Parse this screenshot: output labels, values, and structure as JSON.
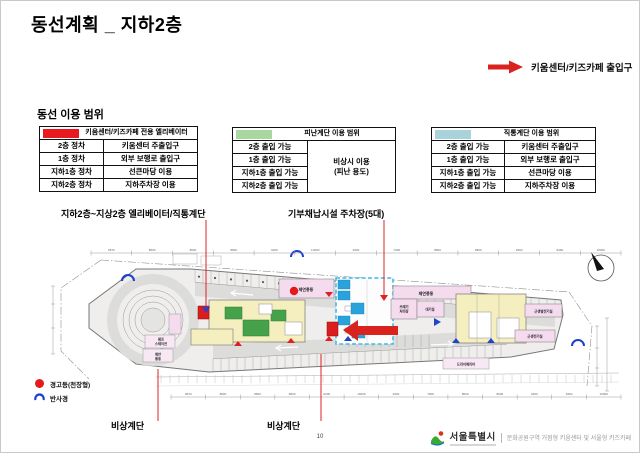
{
  "slide": {
    "title": "동선계획 _ 지하2층",
    "page_number": "10"
  },
  "callout": {
    "text": "키움센터/키즈카페 출입구"
  },
  "legend": {
    "heading": "동선 이용 범위",
    "elevator_table": {
      "header": "키움센터/키즈카페 전용 엘리베이터",
      "swatch_color": "#e8191f",
      "rows": [
        {
          "floor": "2층 정차",
          "use": "키움센터 주출입구"
        },
        {
          "floor": "1층 정차",
          "use": "외부 보행로 출입구"
        },
        {
          "floor": "지하1층 정차",
          "use": "선큰마당 이용"
        },
        {
          "floor": "지하2층 정차",
          "use": "지하주차장 이용"
        }
      ]
    },
    "escape_stair_table": {
      "header": "피난계단 이용 범위",
      "swatch_color": "#a9d7a0",
      "floors": [
        "2층 출입 가능",
        "1층 출입 가능",
        "지하1층 출입 가능",
        "지하2층 출입 가능"
      ],
      "note_line1": "비상시 이용",
      "note_line2": "(피난 용도)"
    },
    "direct_stair_table": {
      "header": "직통계단 이용 범위",
      "swatch_color": "#a8d3da",
      "rows": [
        {
          "floor": "2층 출입 가능",
          "use": "키움센터 주출입구"
        },
        {
          "floor": "1층 출입 가능",
          "use": "외부 보행로 출입구"
        },
        {
          "floor": "지하1층 출입 가능",
          "use": "선큰마당 이용"
        },
        {
          "floor": "지하2층 출입 가능",
          "use": "지하주차장 이용"
        }
      ]
    }
  },
  "annotations": {
    "elevator_stair": "지하2층~지상2층 엘리베이터/직통계단",
    "donation_parking": "기부채납시설 주차장(5대)",
    "emergency_stair_left": "비상계단",
    "emergency_stair_center": "비상계단"
  },
  "plan": {
    "grid_dims": [
      "9670",
      "8600",
      "8600",
      "8600",
      "9200",
      "10200",
      "9200",
      "7000",
      "8600",
      "8900",
      "9400",
      "9460",
      "10000"
    ],
    "rooms": {
      "smoke_room_1": "제연풍동",
      "smoke_room_2": "제연풍동",
      "trash_line1": "쓰레기",
      "trash_line2": "처리장",
      "waiting_room": "대기실",
      "generator_room": "근생발전기실",
      "electrical_room": "근생전기실",
      "dry_area": "드라이에리어",
      "pump_line1": "펌프",
      "pump_line2": "스테이션",
      "smoke3_line1": "제연",
      "smoke3_line2": "풍동"
    }
  },
  "symbol_legend": {
    "warning_light": "경고등(천장형)",
    "mirror": "반사경"
  },
  "footer": {
    "agency": "서울특별시",
    "project": "문화공원구역 거점형 키움센터 및 서울형 키즈카페"
  },
  "colors": {
    "accent_red": "#e02020",
    "legend_red": "#e8191f",
    "legend_green": "#a9d7a0",
    "legend_teal": "#a8d3da",
    "parking_zone_blue": "#3fb9e9",
    "stair_green": "#46a24a",
    "room_yellow": "#f5efc0",
    "room_pink": "#f4dbee"
  }
}
